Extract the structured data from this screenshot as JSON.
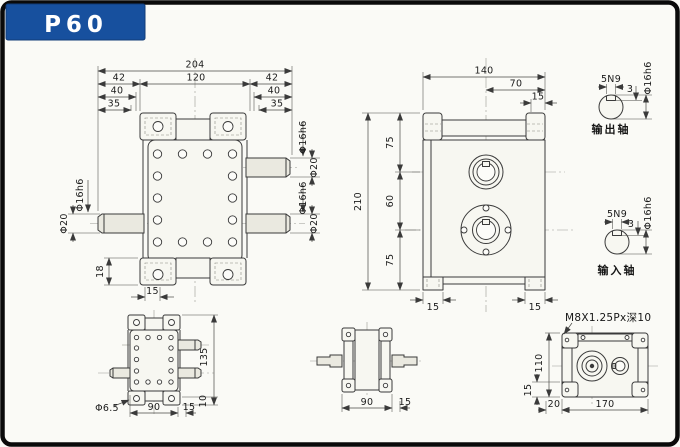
{
  "badge": {
    "model": "P60"
  },
  "colors": {
    "accent": "#17509e",
    "line": "#3a3a3a",
    "paper": "#fafaf6",
    "border": "#0a0a0a"
  },
  "front_view": {
    "dim_total": "204",
    "dim_center": "120",
    "dim_l1": "42",
    "dim_l2": "40",
    "dim_l3": "35",
    "dim_r1": "42",
    "dim_r2": "40",
    "dim_r3": "35",
    "shaft_rt_dia": "Φ16h6",
    "shaft_rt_od": "Φ20",
    "shaft_rb_dia": "Φ16h6",
    "shaft_rb_od": "Φ20",
    "shaft_l_dia": "Φ16h6",
    "shaft_l_od": "Φ20",
    "dim_flange_h": "18",
    "dim_hole_offset": "15"
  },
  "side_view": {
    "dim_width": "140",
    "dim_center": "70",
    "dim_edge": "15",
    "dim_v1": "75",
    "dim_v2": "60",
    "dim_v3": "75",
    "dim_total": "210",
    "dim_foot_l": "15",
    "dim_foot_r": "15"
  },
  "output_shaft": {
    "key": "5N9",
    "depth": "3",
    "dia": "Φ16h6",
    "caption": "输出轴"
  },
  "input_shaft": {
    "key": "5N9",
    "depth": "3",
    "dia": "Φ16h6",
    "caption": "输入轴"
  },
  "bottom_view": {
    "dim_height": "135",
    "hole": "Φ6.5",
    "dim_width": "90",
    "dim_edge": "15",
    "dim_pad": "10"
  },
  "plan_view": {
    "dim_width": "90",
    "dim_edge": "15"
  },
  "rear_view": {
    "thread": "M8X1.25Px深10",
    "dim_height": "110",
    "dim_pad": "15",
    "dim_edge": "20",
    "dim_width": "170"
  }
}
